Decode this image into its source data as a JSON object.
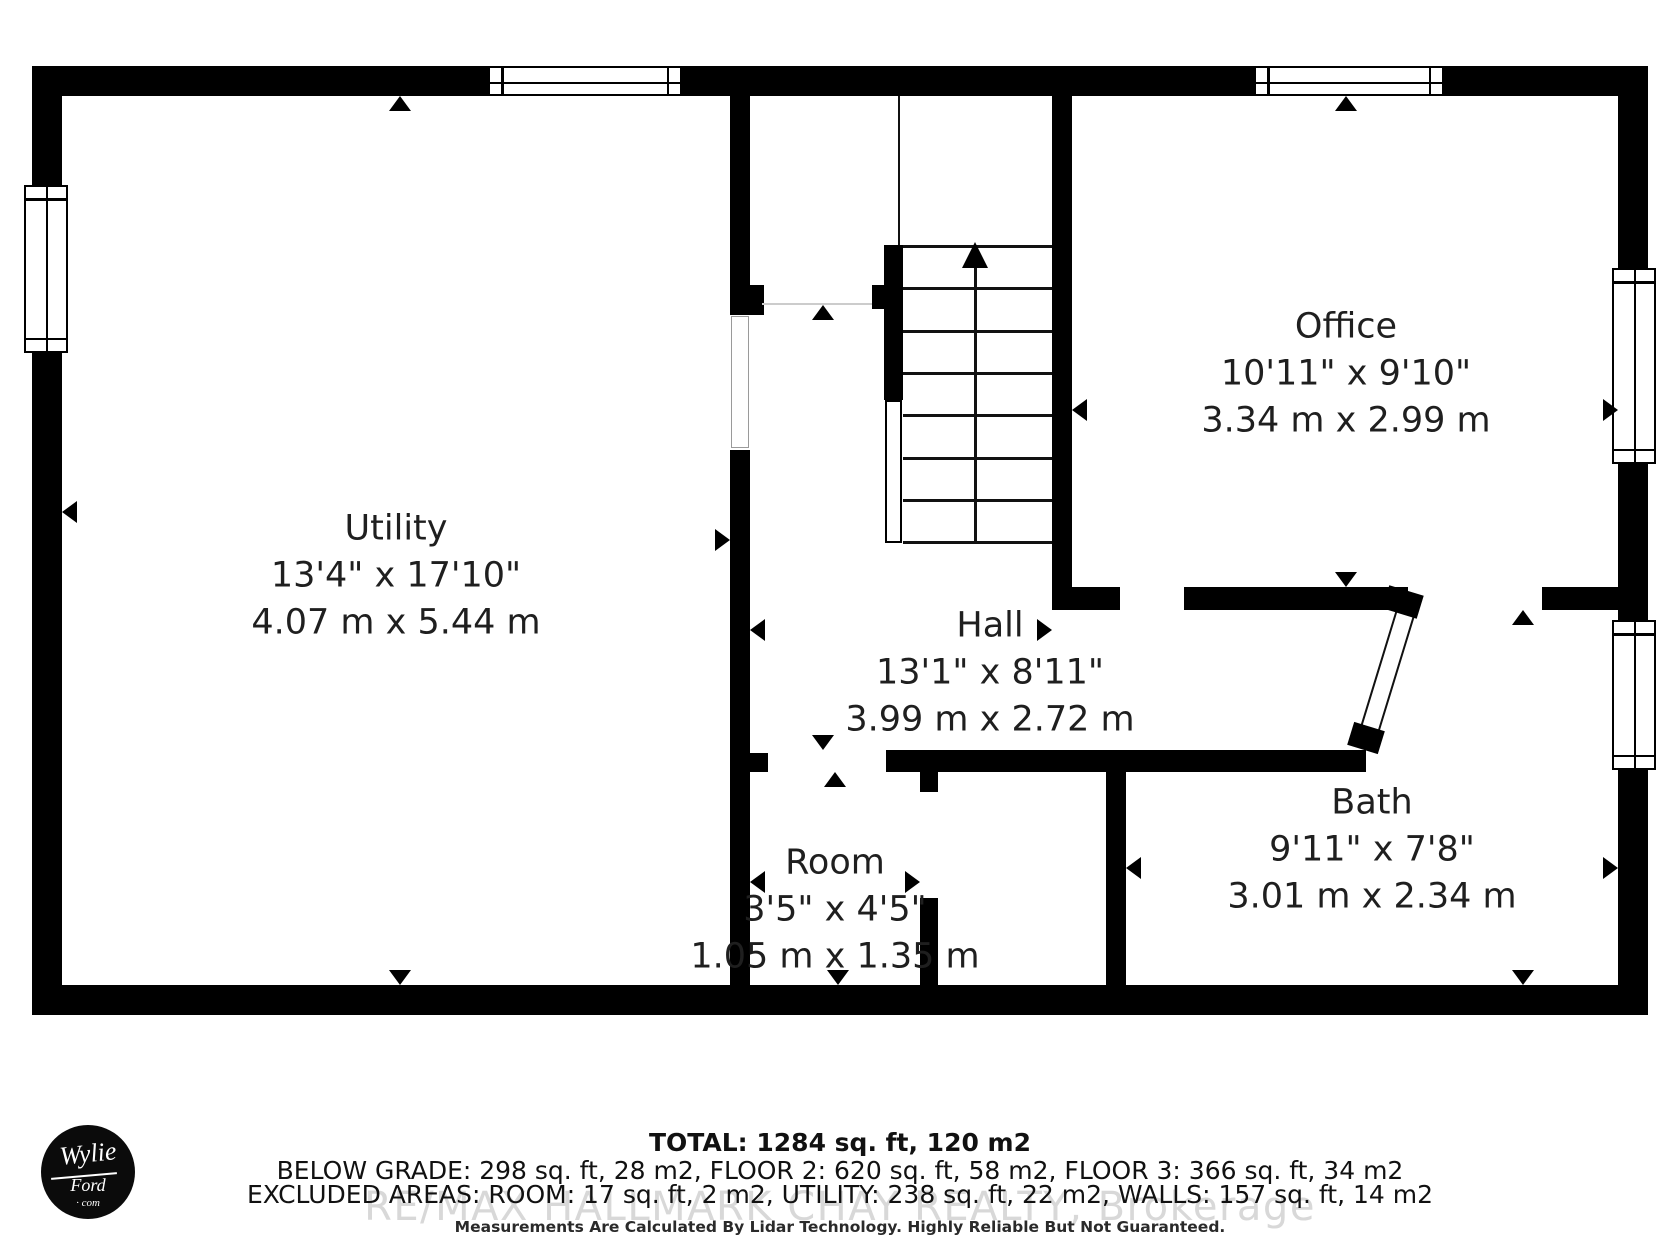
{
  "rooms": [
    {
      "name": "Utility",
      "imperial": "13'4\" x 17'10\"",
      "metric": "4.07 m x 5.44 m"
    },
    {
      "name": "Office",
      "imperial": "10'11\" x 9'10\"",
      "metric": "3.34 m x 2.99 m"
    },
    {
      "name": "Hall",
      "imperial": "13'1\" x 8'11\"",
      "metric": "3.99 m x 2.72 m"
    },
    {
      "name": "Room",
      "imperial": "3'5\" x 4'5\"",
      "metric": "1.05 m x 1.35 m"
    },
    {
      "name": "Bath",
      "imperial": "9'11\" x 7'8\"",
      "metric": "3.01 m x 2.34 m"
    }
  ],
  "summary": {
    "total": "TOTAL: 1284 sq. ft, 120 m2",
    "floors": "BELOW GRADE: 298 sq. ft, 28 m2, FLOOR 2: 620 sq. ft, 58 m2, FLOOR 3: 366 sq. ft, 34 m2",
    "excluded": "EXCLUDED AREAS: ROOM: 17 sq. ft, 2 m2, UTILITY: 238 sq. ft, 22 m2, WALLS: 157 sq. ft, 14 m2",
    "disclaimer": "Measurements Are Calculated By Lidar Technology. Highly Reliable But Not Guaranteed."
  },
  "watermark": "RE/MAX HALLMARK CHAY REALTY, Brokerage",
  "logo": {
    "line1": "Wylie",
    "line2": "Ford",
    "line3": "· com"
  },
  "colors": {
    "wall": "#000000",
    "label_text": "#1f1f1f",
    "watermark": "#cccccc"
  }
}
